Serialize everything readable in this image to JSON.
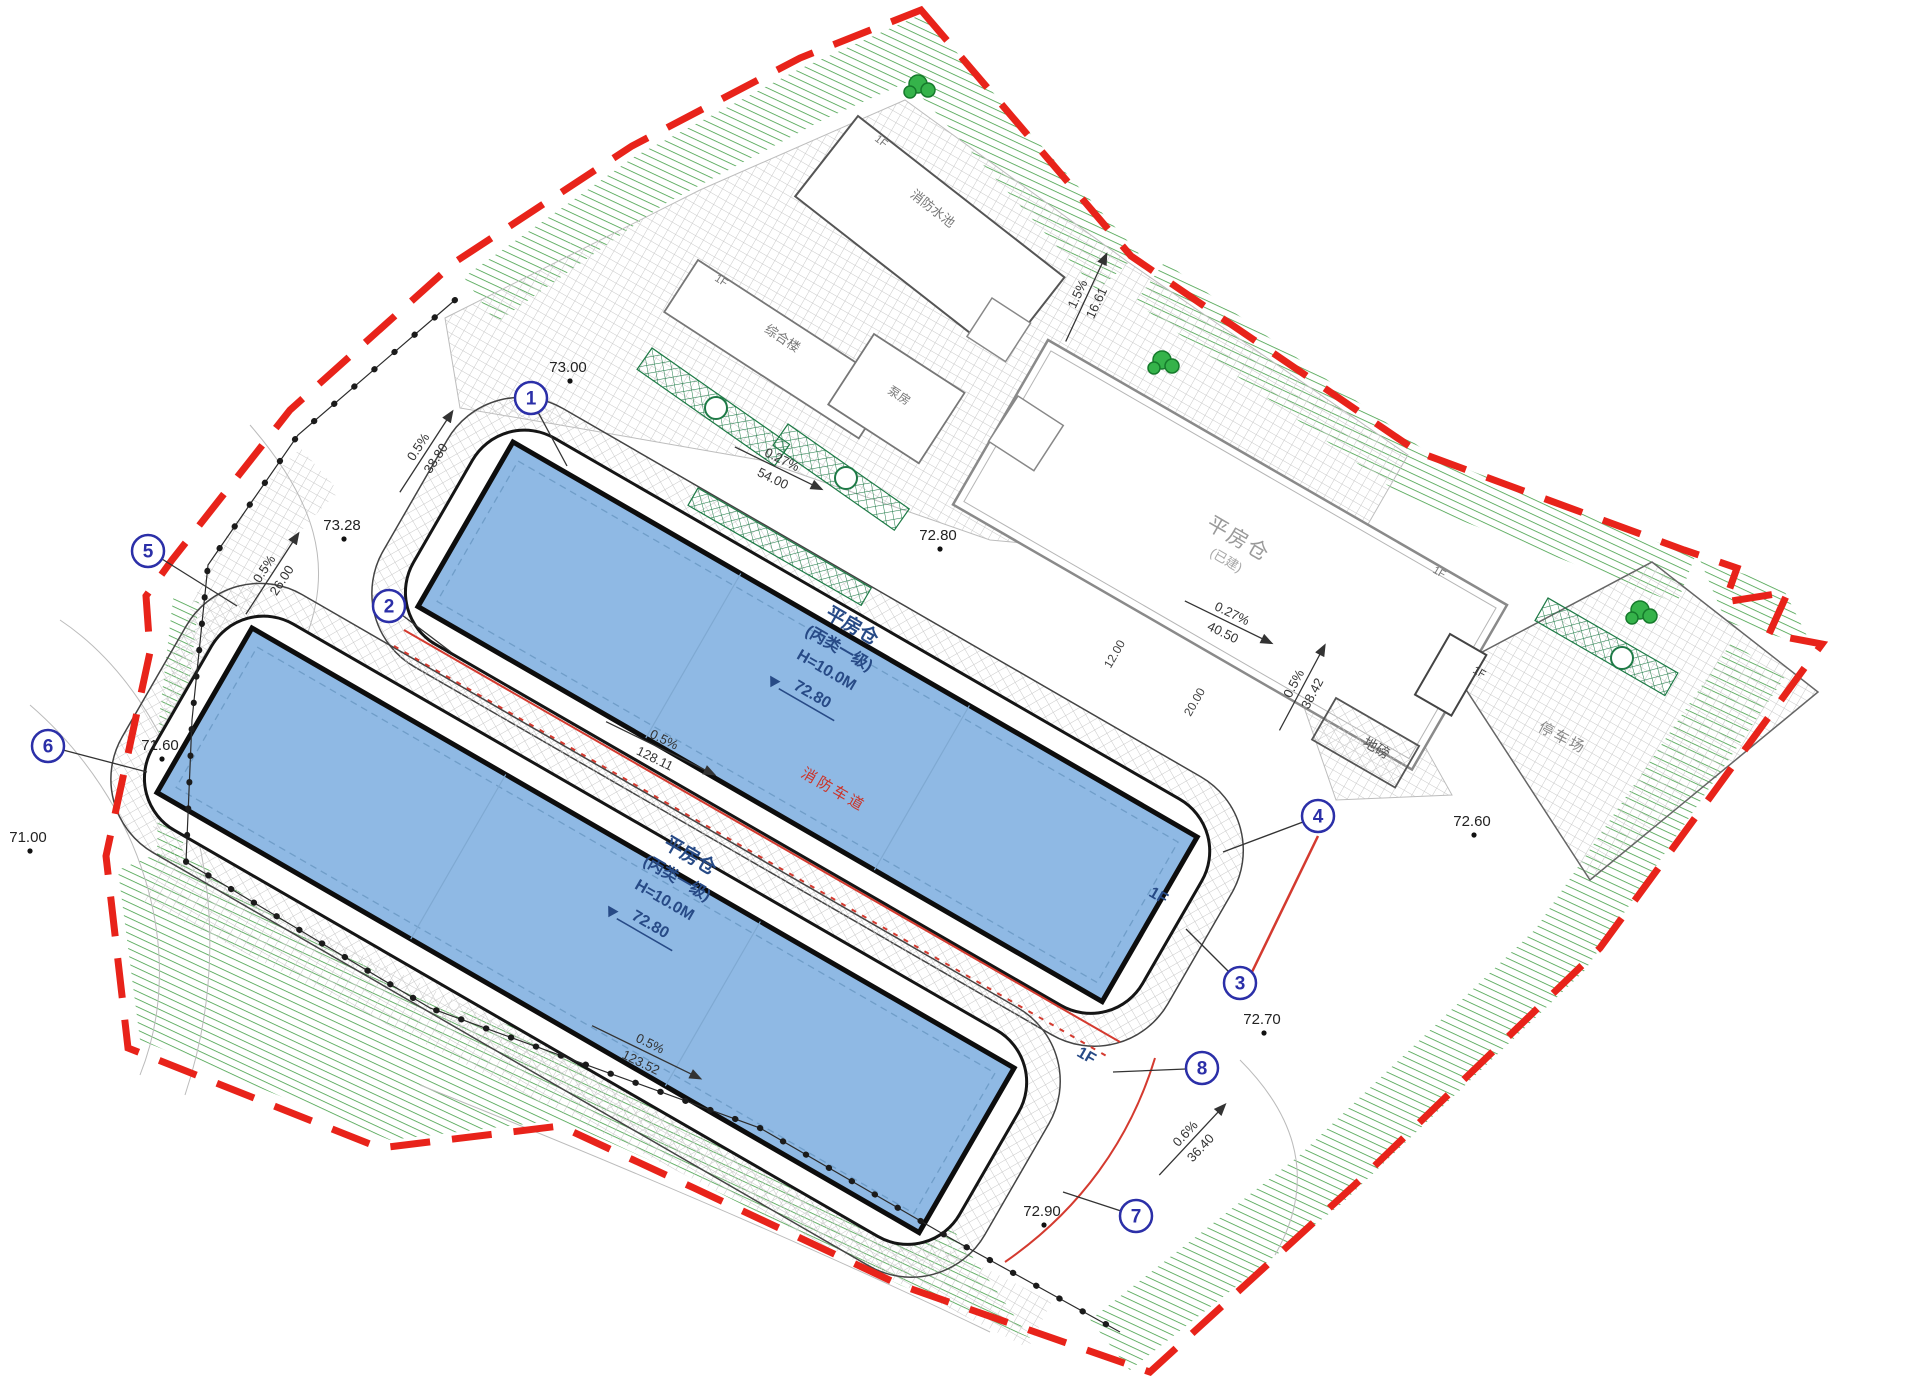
{
  "palette": {
    "boundary_red": "#e8231a",
    "building_blue": "#8fb9e4",
    "label_navy": "#274a86",
    "belt_green": "#3f9d44",
    "hatch_grey": "#c9c9c9"
  },
  "warehouses": {
    "upper": {
      "l1": "平房仓",
      "l2": "(丙类一级)",
      "l3": "H=10.0M",
      "elev": "72.80",
      "floor": "1F"
    },
    "lower": {
      "l1": "平房仓",
      "l2": "(丙类一级)",
      "l3": "H=10.0M",
      "elev": "72.80",
      "floor": "1F"
    },
    "existing": {
      "name": "平房仓",
      "note": "(已建)",
      "floor": "1F"
    }
  },
  "facilities": {
    "fire_pool": "消防水池",
    "office": "综合楼",
    "pump_room": "泵房",
    "weighbridge": "地磅",
    "parking": "停车场",
    "gate_house_floor": "1F",
    "fire_pool_floor": "1F",
    "office_floor": "1F"
  },
  "fire_lane_label": "消防车道",
  "axes": [
    {
      "n": "1"
    },
    {
      "n": "2"
    },
    {
      "n": "3"
    },
    {
      "n": "4"
    },
    {
      "n": "5"
    },
    {
      "n": "6"
    },
    {
      "n": "7"
    },
    {
      "n": "8"
    }
  ],
  "elevations": [
    {
      "v": "73.00"
    },
    {
      "v": "73.28"
    },
    {
      "v": "72.80"
    },
    {
      "v": "72.60"
    },
    {
      "v": "72.70"
    },
    {
      "v": "72.90"
    },
    {
      "v": "71.60"
    },
    {
      "v": "71.00"
    }
  ],
  "slopes": [
    {
      "grade": "0.5%",
      "len": "38.80"
    },
    {
      "grade": "0.27%",
      "len": "54.00"
    },
    {
      "grade": "0.5%",
      "len": "26.00"
    },
    {
      "grade": "0.27%",
      "len": "40.50"
    },
    {
      "grade": "0.5%",
      "len": "38.42"
    },
    {
      "grade": "0.6%",
      "len": "36.40"
    },
    {
      "grade": "1.5%",
      "len": "16.61"
    },
    {
      "grade": "0.5%",
      "len": "123.52"
    },
    {
      "grade": "0.5%",
      "len": "128.11"
    }
  ],
  "dims": [
    {
      "v": "12.00"
    },
    {
      "v": "20.00"
    }
  ]
}
